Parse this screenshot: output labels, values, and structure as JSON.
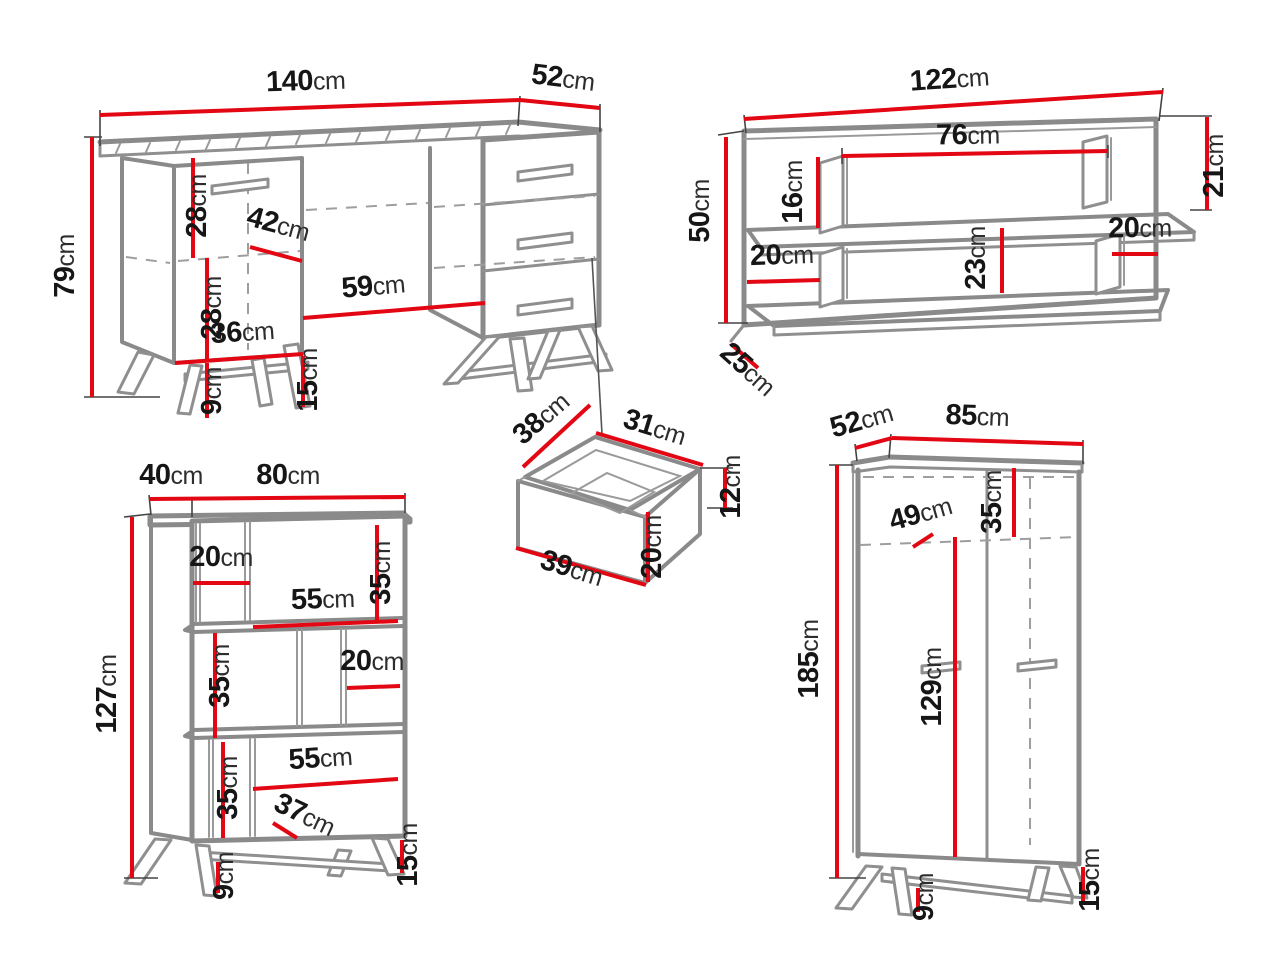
{
  "title": "Furniture set technical dimensions diagram",
  "unit": "cm",
  "colors": {
    "dimension": "#e30613",
    "outline": "#8a8a8a",
    "text": "#161616",
    "background": "#ffffff"
  },
  "furniture": {
    "desk": {
      "label": "desk",
      "width": "140",
      "depth": "52",
      "height": "79",
      "upper_section": "28",
      "opening": "42",
      "lower_section": "28",
      "niche_width": "59",
      "cabinet_width": "36",
      "floor_clearance": "9",
      "leg_height": "15"
    },
    "wall_shelf": {
      "label": "wall shelf",
      "width": "122",
      "inner_width": "76",
      "right_height": "21",
      "divider_height": "16",
      "height": "50",
      "left_opening": "20",
      "middle_height": "23",
      "right_opening": "20",
      "depth": "25"
    },
    "drawer": {
      "label": "drawer detail",
      "side_depth": "38",
      "inner_width": "31",
      "inner_height": "12",
      "front_height": "20",
      "front_width": "39"
    },
    "bookcase": {
      "label": "bookcase",
      "depth": "40",
      "width": "80",
      "top_opening": "20",
      "top_section": "35",
      "top_shelf": "55",
      "middle_section": "35",
      "middle_opening": "20",
      "height": "127",
      "bottom_section": "35",
      "bottom_shelf": "55",
      "bottom_opening": "37",
      "floor_clearance": "9",
      "leg_height": "15"
    },
    "wardrobe": {
      "label": "wardrobe",
      "depth": "52",
      "width": "85",
      "shelf_depth": "49",
      "top_section": "35",
      "height": "185",
      "inner_height": "129",
      "floor_clearance": "9",
      "leg_height": "15"
    }
  }
}
